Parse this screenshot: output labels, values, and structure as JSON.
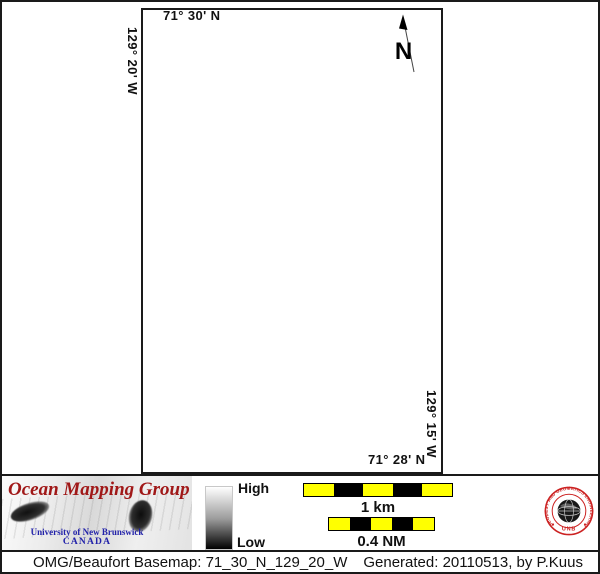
{
  "map": {
    "top_lat": "71° 30' N",
    "left_lon": "129° 20' W",
    "right_lon": "129° 15' W",
    "bottom_lat": "71° 28' N",
    "north_arrow_label": "N"
  },
  "legend": {
    "colorbar_high": "High",
    "colorbar_low": "Low",
    "colorbar_gradient_top": "#ffffff",
    "colorbar_gradient_bottom": "#000000",
    "scale_km_label": "1 km",
    "scale_nm_label": "0.4 NM",
    "scale_segment_colors": [
      "#ffff00",
      "#000000",
      "#ffff00",
      "#000000",
      "#ffff00"
    ]
  },
  "branding": {
    "omg_title": "Ocean Mapping Group",
    "omg_university": "University of New Brunswick",
    "omg_country": "CANADA",
    "omg_title_color": "#a01818",
    "omg_text_blue": "#2222aa",
    "seal_ring_text": "GEODESY AND GEOMATICS ENGINEERING",
    "seal_name": "UNB",
    "seal_color": "#cc2222"
  },
  "caption": {
    "basemap": "OMG/Beaufort Basemap: 71_30_N_129_20_W",
    "generated": "Generated: 20110513, by P.Kuus"
  }
}
